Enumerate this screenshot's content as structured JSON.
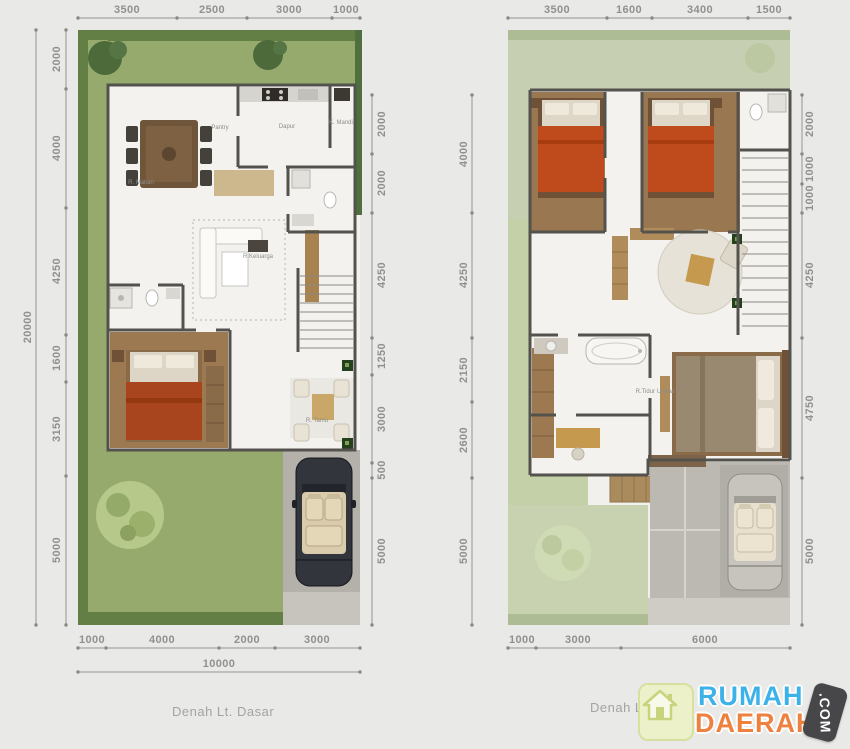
{
  "plans": {
    "left": {
      "caption": "Denah Lt. Dasar",
      "dims_top": [
        "3500",
        "2500",
        "3000",
        "1000"
      ],
      "dims_left": [
        "2000",
        "4000",
        "4250",
        "1600",
        "3150",
        "5000"
      ],
      "total_height": "20000",
      "dims_right": [
        "2000",
        "2000",
        "4250",
        "1250",
        "3000",
        "500",
        "5000"
      ],
      "dims_bottom": [
        "1000",
        "4000",
        "2000",
        "3000"
      ],
      "total_width": "10000",
      "rooms": {
        "dining": "R. Makan",
        "pantry": "Pantry",
        "kitchen": "Dapur",
        "bath": "K. Mandi",
        "family": "R.Keluarga",
        "guest": "R. Tamu"
      }
    },
    "right": {
      "caption": "Denah L",
      "dims_top": [
        "3500",
        "1600",
        "3400",
        "1500"
      ],
      "dims_left": [
        "4000",
        "4250",
        "2150",
        "2600",
        "5000"
      ],
      "dims_right": [
        "2000",
        "1000",
        "1000",
        "4250",
        "4750",
        "5000"
      ],
      "dims_bottom": [
        "1000",
        "3000",
        "6000"
      ],
      "rooms": {
        "master": "R.Tidur Utama"
      }
    }
  },
  "branding": {
    "name_top": "RUMAH",
    "name_bottom": "DAERAH",
    "badge": ".COM",
    "colors": {
      "name_top": "#3db2e8",
      "name_bottom": "#ee8140",
      "badge_bg": "#47474a"
    }
  }
}
